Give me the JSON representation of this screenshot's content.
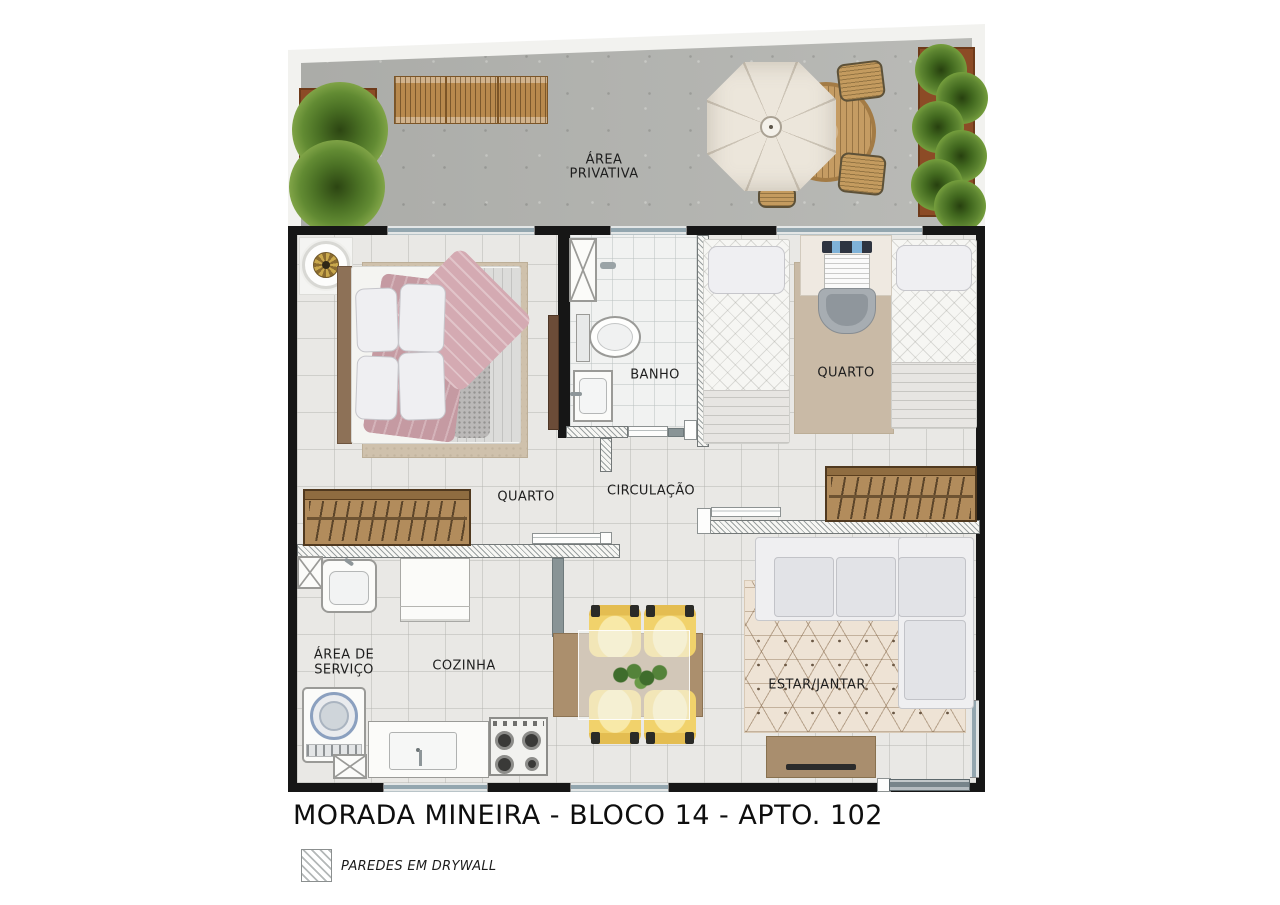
{
  "plan": {
    "title": "MORADA MINEIRA -  BLOCO 14 - APTO. 102",
    "legend_drywall": "PAREDES EM DRYWALL",
    "rooms": {
      "area_privativa": {
        "line1": "ÁREA",
        "line2": "PRIVATIVA"
      },
      "quarto1": {
        "label": "QUARTO"
      },
      "banho": {
        "label": "BANHO"
      },
      "quarto2": {
        "label": "QUARTO"
      },
      "circulacao": {
        "label": "CIRCULAÇÃO"
      },
      "area_servico": {
        "line1": "ÁREA DE",
        "line2": "SERVIÇO"
      },
      "cozinha": {
        "label": "COZINHA"
      },
      "estar_jantar": {
        "label": "ESTAR/JANTAR"
      }
    },
    "colors": {
      "wall_black": "#161616",
      "drywall_hatch": "#9aa0a0",
      "concrete": "#b4b5b1",
      "wood": "#b28c5c",
      "chair_yellow": "#f1d26b",
      "rose_blanket": "#c79ba3",
      "plant_green": "#5d8531",
      "floor_tile": "#e9e8e5"
    }
  }
}
